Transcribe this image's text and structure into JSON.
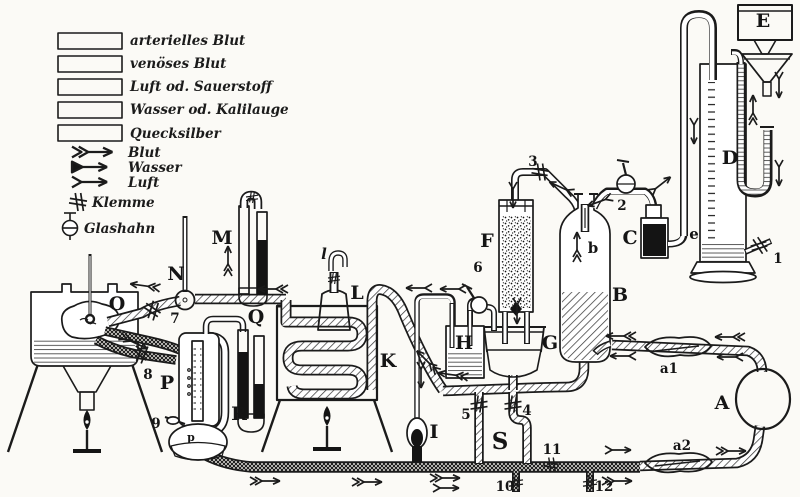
{
  "legend": {
    "swatches": [
      {
        "icon": "swatch-diagonal-hatch",
        "label": "arterielles Blut"
      },
      {
        "icon": "swatch-cross-hatch",
        "label": "venöses Blut"
      },
      {
        "icon": "swatch-plain-white",
        "label": "Luft od. Sauerstoff"
      },
      {
        "icon": "swatch-horizontal-lines",
        "label": "Wasser od. Kalilauge"
      },
      {
        "icon": "swatch-solid-black",
        "label": "Quecksilber"
      }
    ],
    "flow_arrows": [
      {
        "icon": "arrow-double-chevron",
        "label": "Blut"
      },
      {
        "icon": "arrow-filled-head",
        "label": "Wasser"
      },
      {
        "icon": "arrow-single-chevron",
        "label": "Luft"
      }
    ],
    "symbols": [
      {
        "icon": "clamp-symbol",
        "label": "Klemme"
      },
      {
        "icon": "stopcock-symbol",
        "label": "Glashahn"
      }
    ]
  },
  "labels": {
    "A": "A",
    "B": "B",
    "C": "C",
    "D": "D",
    "E": "E",
    "F": "F",
    "G": "G",
    "H": "H",
    "I": "I",
    "K": "K",
    "L": "L",
    "M": "M",
    "N": "N",
    "O": "O",
    "P": "P",
    "Q": "Q",
    "R": "R",
    "S": "S",
    "a1": "a1",
    "a2": "a2",
    "b": "b",
    "e": "e",
    "l": "l",
    "p": "p",
    "n1": "1",
    "n2": "2",
    "n3": "3",
    "n4": "4",
    "n5": "5",
    "n6": "6",
    "n7": "7",
    "n8": "8",
    "n9": "9",
    "n10": "10",
    "n11": "11",
    "n12": "12"
  }
}
